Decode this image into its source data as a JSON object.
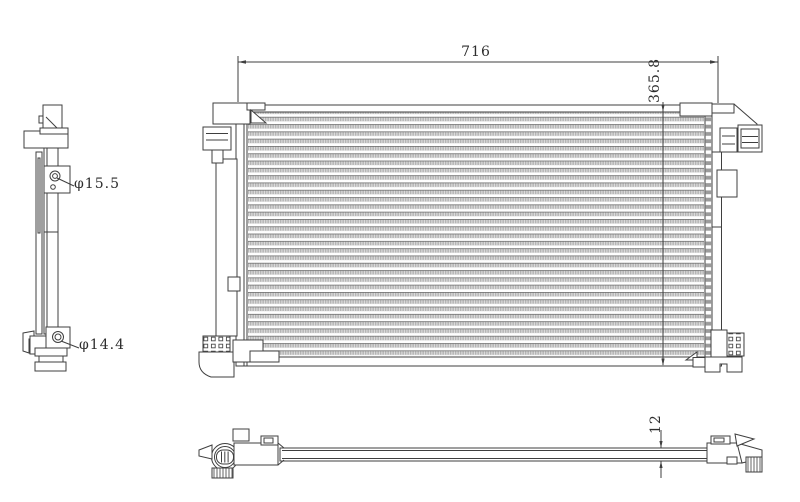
{
  "meta": {
    "background": "#ffffff",
    "line_color": "#3f3f3f",
    "fin_color": "#b5b5b5"
  },
  "dimensions": {
    "width": "716",
    "height": "365.8",
    "thickness": "12",
    "port_top": "φ15.5",
    "port_bottom": "φ14.4"
  }
}
